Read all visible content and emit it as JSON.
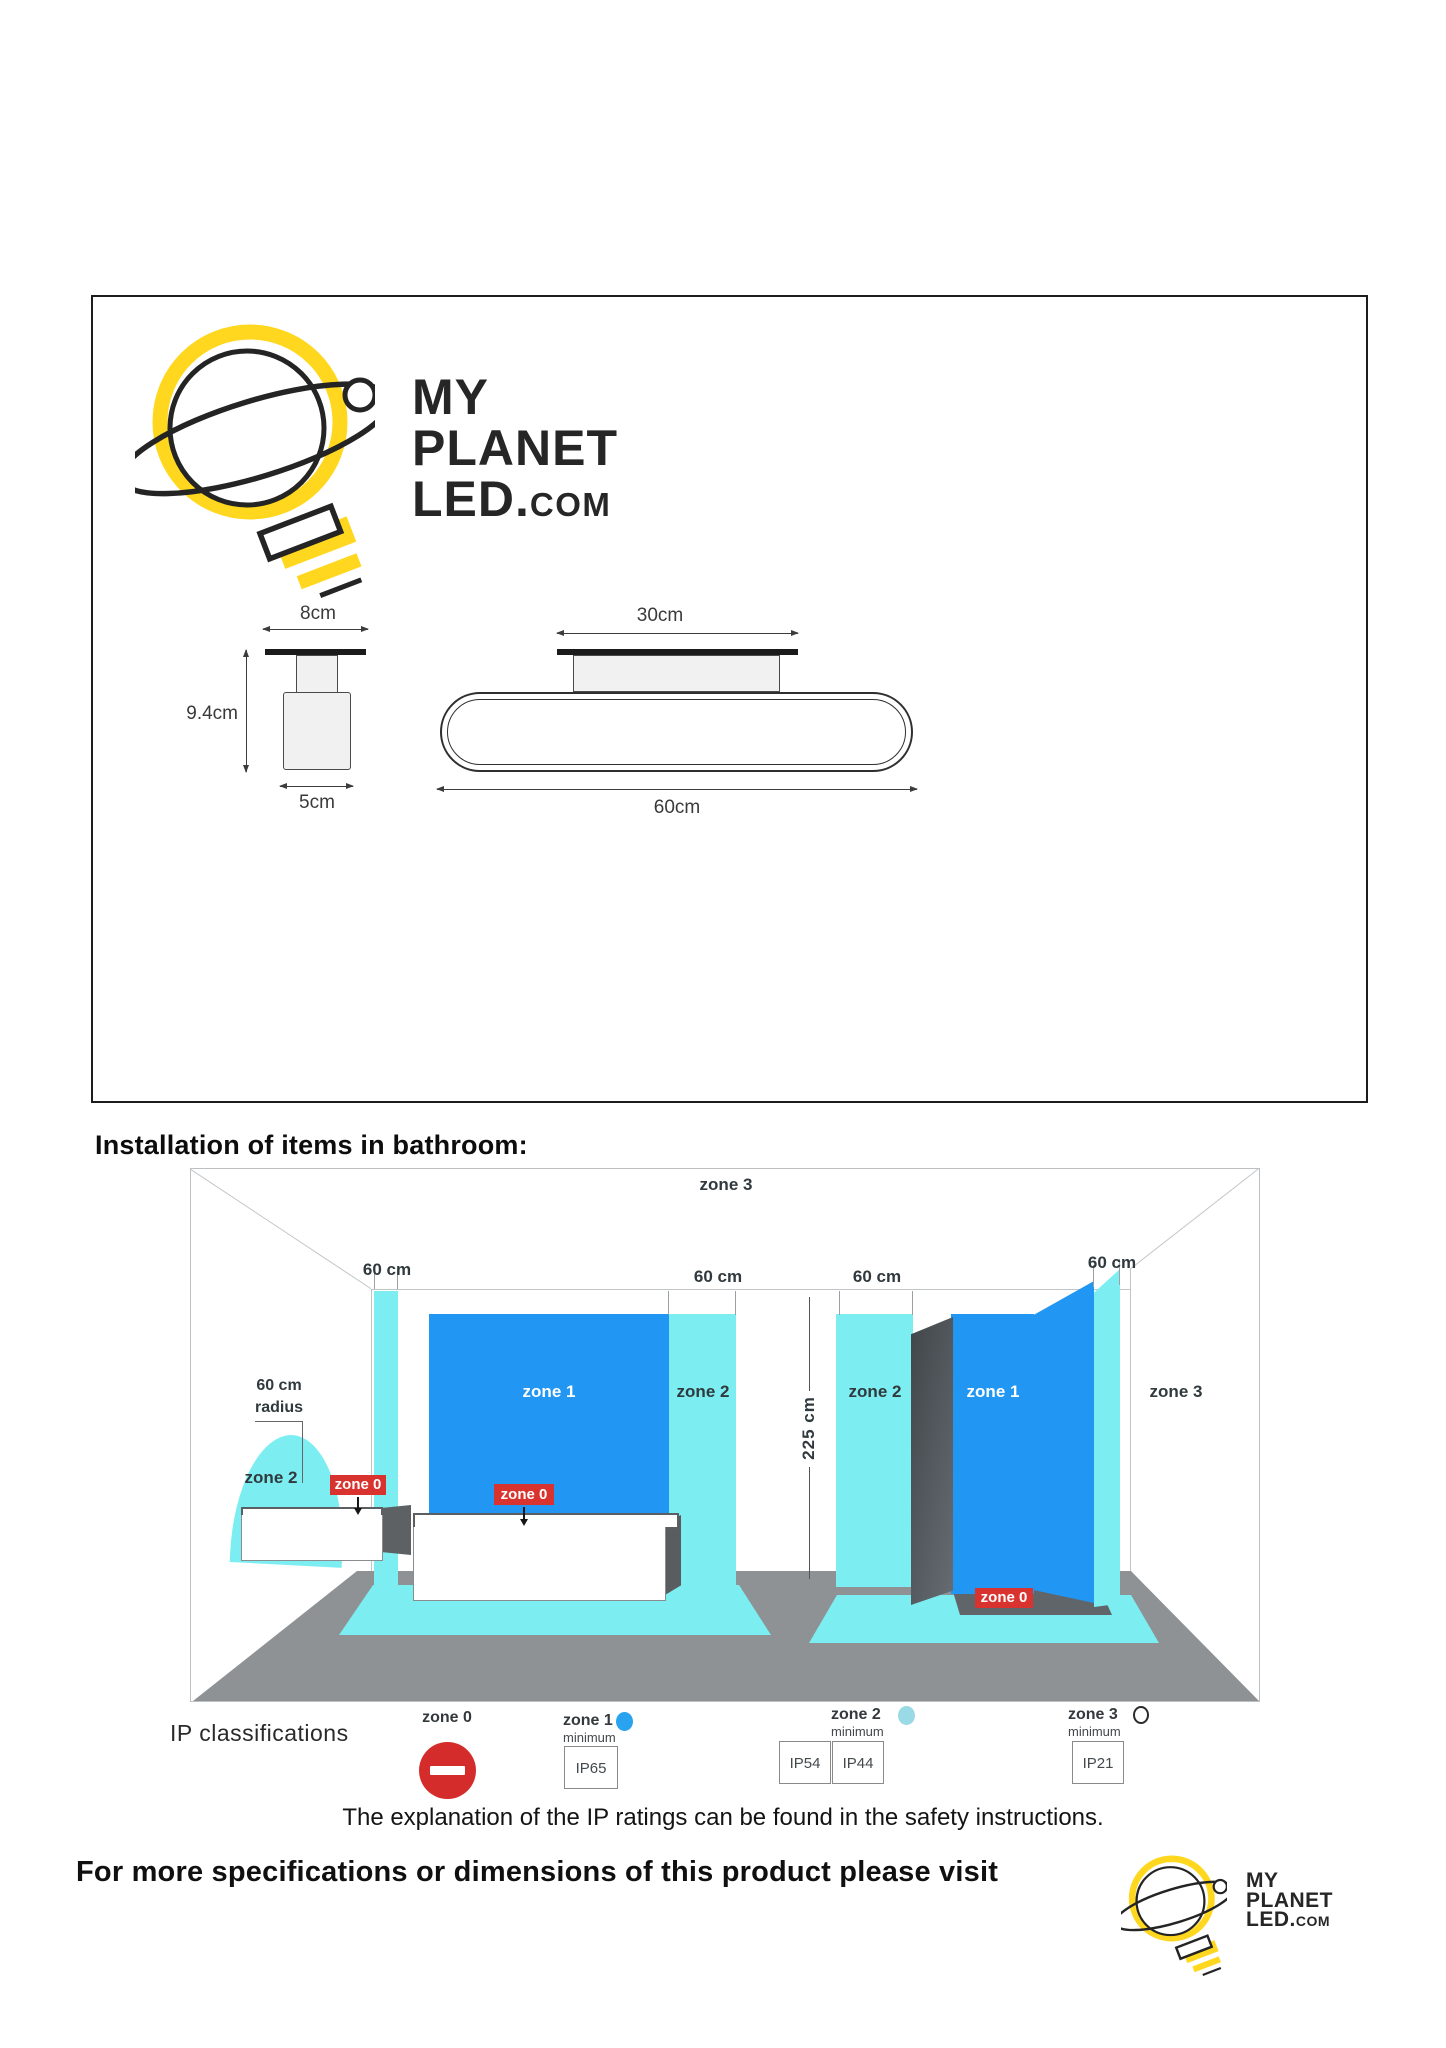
{
  "brand": {
    "line1": "MY",
    "line2": "PLANET",
    "line3_led": "LED.",
    "line3_com": "COM"
  },
  "dimensions": {
    "side_width": "8cm",
    "side_height": "9.4cm",
    "side_base": "5cm",
    "front_plate": "30cm",
    "front_width": "60cm"
  },
  "bathroom": {
    "heading": "Installation of items in bathroom:",
    "dim_60": "60 cm",
    "dim_height": "225 cm",
    "radius_value": "60 cm",
    "radius_word": "radius",
    "zone0": "zone 0",
    "zone1": "zone 1",
    "zone2": "zone 2",
    "zone3": "zone 3"
  },
  "legend": {
    "title": "IP classifications",
    "minimum": "minimum",
    "zone0_name": "zone 0",
    "zone1_name": "zone 1",
    "zone2_name": "zone 2",
    "zone3_name": "zone 3",
    "zone1_rating": "IP65",
    "zone2_rating_a": "IP54",
    "zone2_rating_b": "IP44",
    "zone3_rating": "IP21",
    "zone1_dot_color": "#29a3ef",
    "zone2_dot_color": "#9ad9e6",
    "zone3_dot_color": "#ffffff"
  },
  "footer": {
    "note": "The explanation of the IP ratings can be found in the safety instructions.",
    "cta": "For more specifications or dimensions of this product please visit"
  },
  "colors": {
    "brand_yellow": "#ffd71e",
    "zone1_blue": "#2196f3",
    "zone2_cyan": "#7ceef2",
    "zone0_red": "#d8332f",
    "noentry_red": "#d42b2b",
    "floor_gray": "#8f9294"
  }
}
